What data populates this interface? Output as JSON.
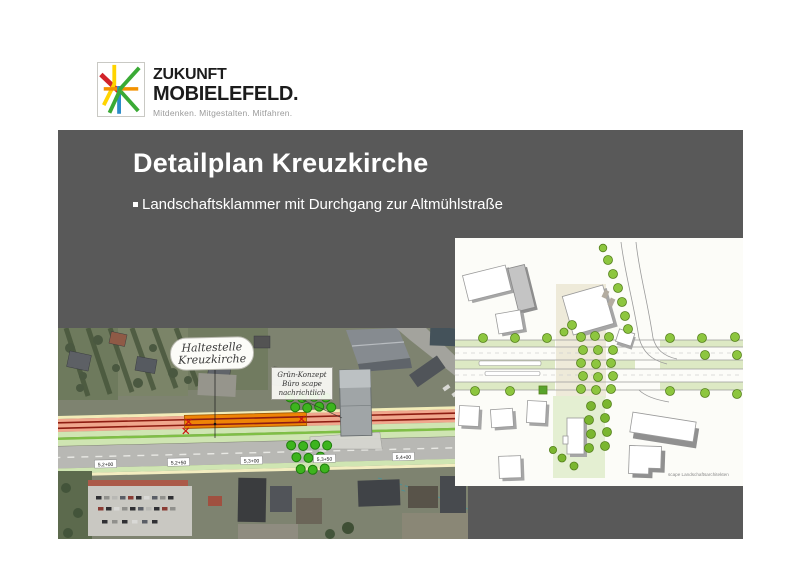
{
  "slide": {
    "background": "#ffffff",
    "panel_color": "#595959"
  },
  "logo": {
    "brand_line1": "ZUKUNFT",
    "brand_line2": "MOBIELEFELD.",
    "tagline": "Mitdenken. Mitgestalten. Mitfahren.",
    "palette": {
      "red": "#d2232a",
      "yellow": "#ffd400",
      "green": "#3aaa35",
      "blue": "#2b8cc9",
      "orange": "#f39200"
    }
  },
  "header": {
    "title": "Detailplan Kreuzkirche",
    "bullet": "Landschaftsklammer mit Durchgang zur Altmühlstraße"
  },
  "aerial_map": {
    "stop_label_line1": "Haltestelle",
    "stop_label_line2": "Kreuzkirche",
    "note_lines": [
      "Grün-Konzept",
      "Büro scape",
      "nachrichtlich"
    ],
    "chainage_labels": [
      "5,2+00",
      "5,2+50",
      "5,3+00",
      "5,3+50",
      "5,4+00"
    ],
    "overlay_colors": {
      "tram_track": "#8e1d12",
      "platform": "#ee8406",
      "green_strip": "#cfe5b2",
      "road": "#b8b8b4",
      "corridor": "#f0a78d"
    }
  },
  "plan_drawing": {
    "credit": "scape Landschaftsarchitekten",
    "tree_color": "#8dc63f"
  }
}
